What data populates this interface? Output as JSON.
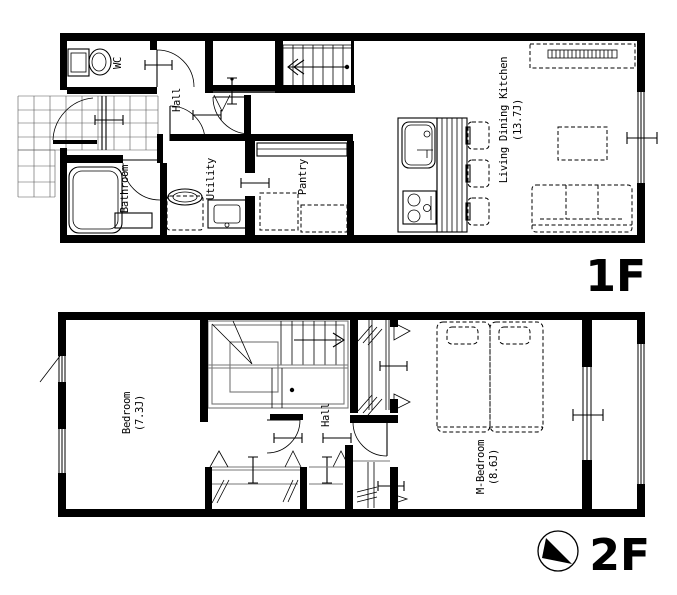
{
  "floor1": {
    "label": "1F",
    "wc": "WC",
    "hall": "Hall",
    "bathroom": "Bathroom",
    "utility": "Utility",
    "pantry": "Pantry",
    "ldk": "Living Dining Kitchen",
    "ldk_size": "(13.7J)"
  },
  "floor2": {
    "label": "2F",
    "bedroom": "Bedroom",
    "bedroom_size": "(7.3J)",
    "hall": "Hall",
    "m_bedroom": "M-Bedroom",
    "m_bedroom_size": "(8.6J)"
  },
  "icons": {
    "compass": "north-arrow"
  },
  "colors": {
    "line": "#000000",
    "background": "#ffffff",
    "rail": "#777777"
  }
}
